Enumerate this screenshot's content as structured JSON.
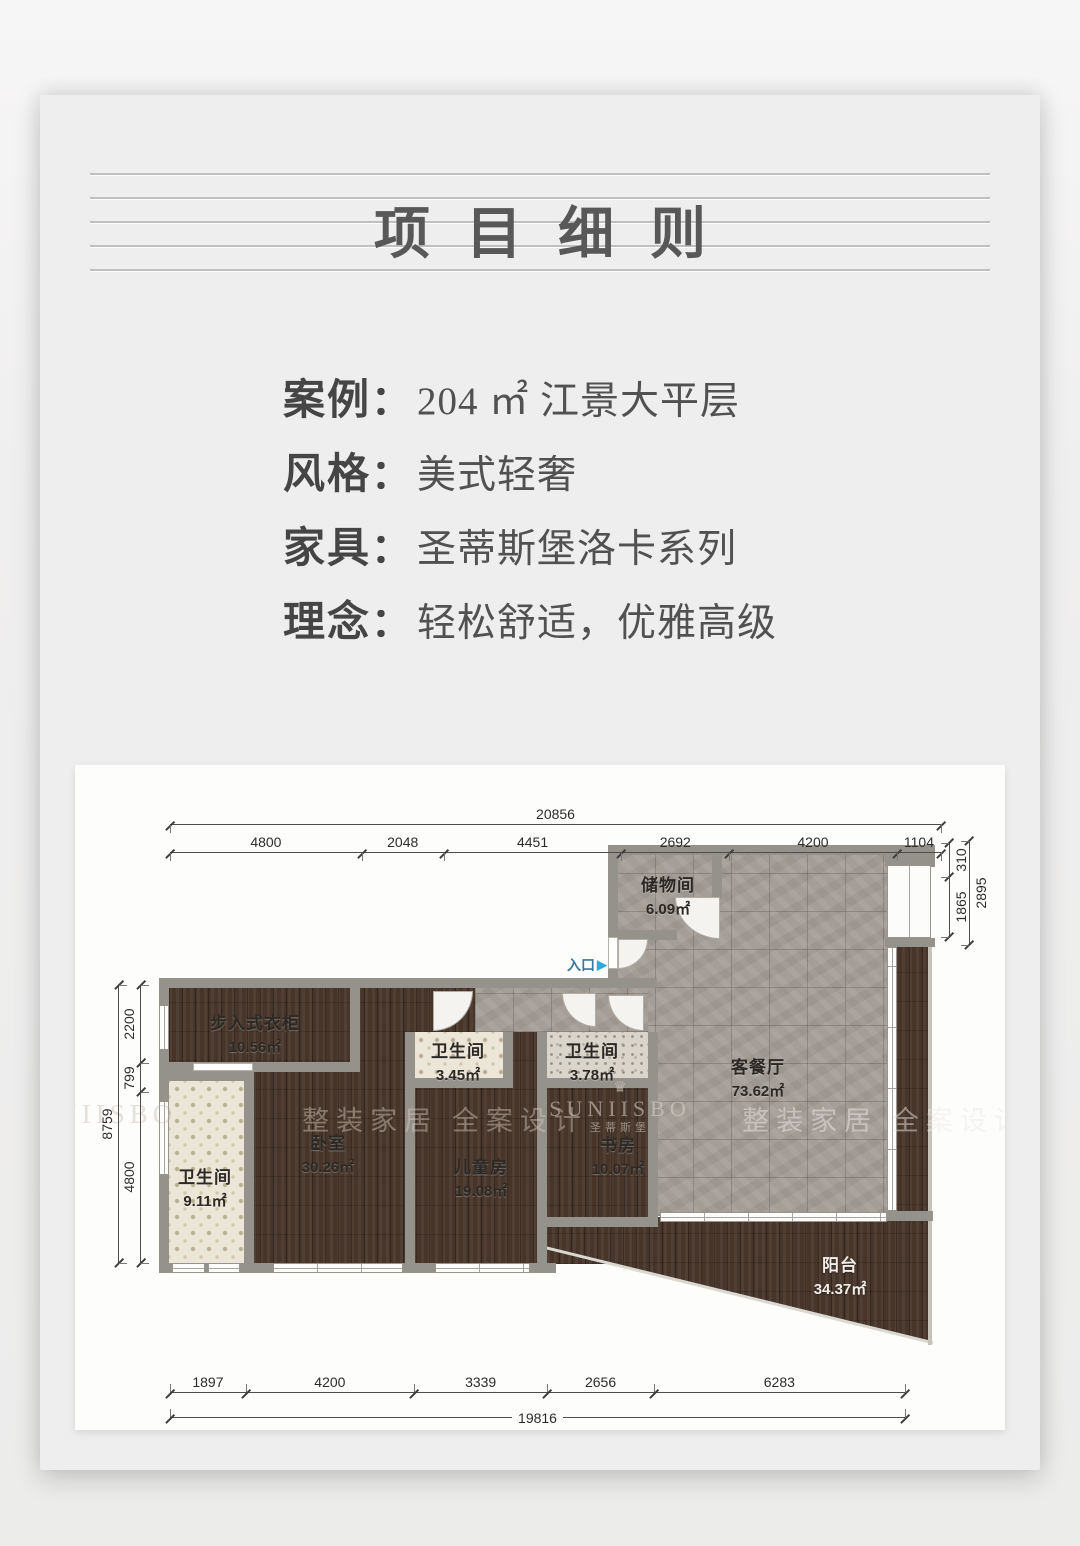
{
  "page": {
    "title": "项目细则"
  },
  "info": {
    "separator": "：",
    "rows": [
      {
        "label": "案例",
        "value": "204 ㎡ 江景大平层"
      },
      {
        "label": "风格",
        "value": "美式轻奢"
      },
      {
        "label": "家具",
        "value": "圣蒂斯堡洛卡系列"
      },
      {
        "label": "理念",
        "value": "轻松舒适，优雅高级"
      }
    ]
  },
  "floorplan": {
    "entrance": {
      "label": "入口",
      "arrow": "▶"
    },
    "rooms": [
      {
        "id": "storage",
        "name": "储物间",
        "area": "6.09㎡"
      },
      {
        "id": "living",
        "name": "客餐厅",
        "area": "73.62㎡"
      },
      {
        "id": "closet",
        "name": "步入式衣柜",
        "area": "10.56㎡"
      },
      {
        "id": "bath-left",
        "name": "卫生间",
        "area": "9.11㎡"
      },
      {
        "id": "bedroom",
        "name": "卧室",
        "area": "30.26㎡"
      },
      {
        "id": "bath-mid",
        "name": "卫生间",
        "area": "3.45㎡"
      },
      {
        "id": "kids-room",
        "name": "儿童房",
        "area": "19.08㎡"
      },
      {
        "id": "bath-right",
        "name": "卫生间",
        "area": "3.78㎡"
      },
      {
        "id": "study",
        "name": "书房",
        "area": "10.07㎡"
      },
      {
        "id": "balcony",
        "name": "阳台",
        "area": "34.37㎡"
      }
    ],
    "dimensions": {
      "top": {
        "total": "20856",
        "segments": [
          "4800",
          "2048",
          "4451",
          "2692",
          "4200",
          "1104"
        ]
      },
      "bottom": {
        "total": "19816",
        "segments": [
          "1897",
          "4200",
          "3339",
          "2656",
          "6283"
        ]
      },
      "left": {
        "total": "8759",
        "segments": [
          "2200",
          "799",
          "4800"
        ]
      },
      "right": {
        "total": "2895",
        "segments": [
          "310",
          "1865"
        ]
      }
    },
    "watermarks": {
      "slogan": "整装家居 全案设计",
      "brand": "SUNIISBO",
      "brand_cn": "圣蒂斯堡",
      "crown": "♛"
    },
    "colors": {
      "entrance_text": "#34789e",
      "entrance_arrow": "#2fa9d8",
      "wall": "#95928b",
      "wood_floor": "#47352a",
      "stone_tile": "#a49e97"
    }
  }
}
